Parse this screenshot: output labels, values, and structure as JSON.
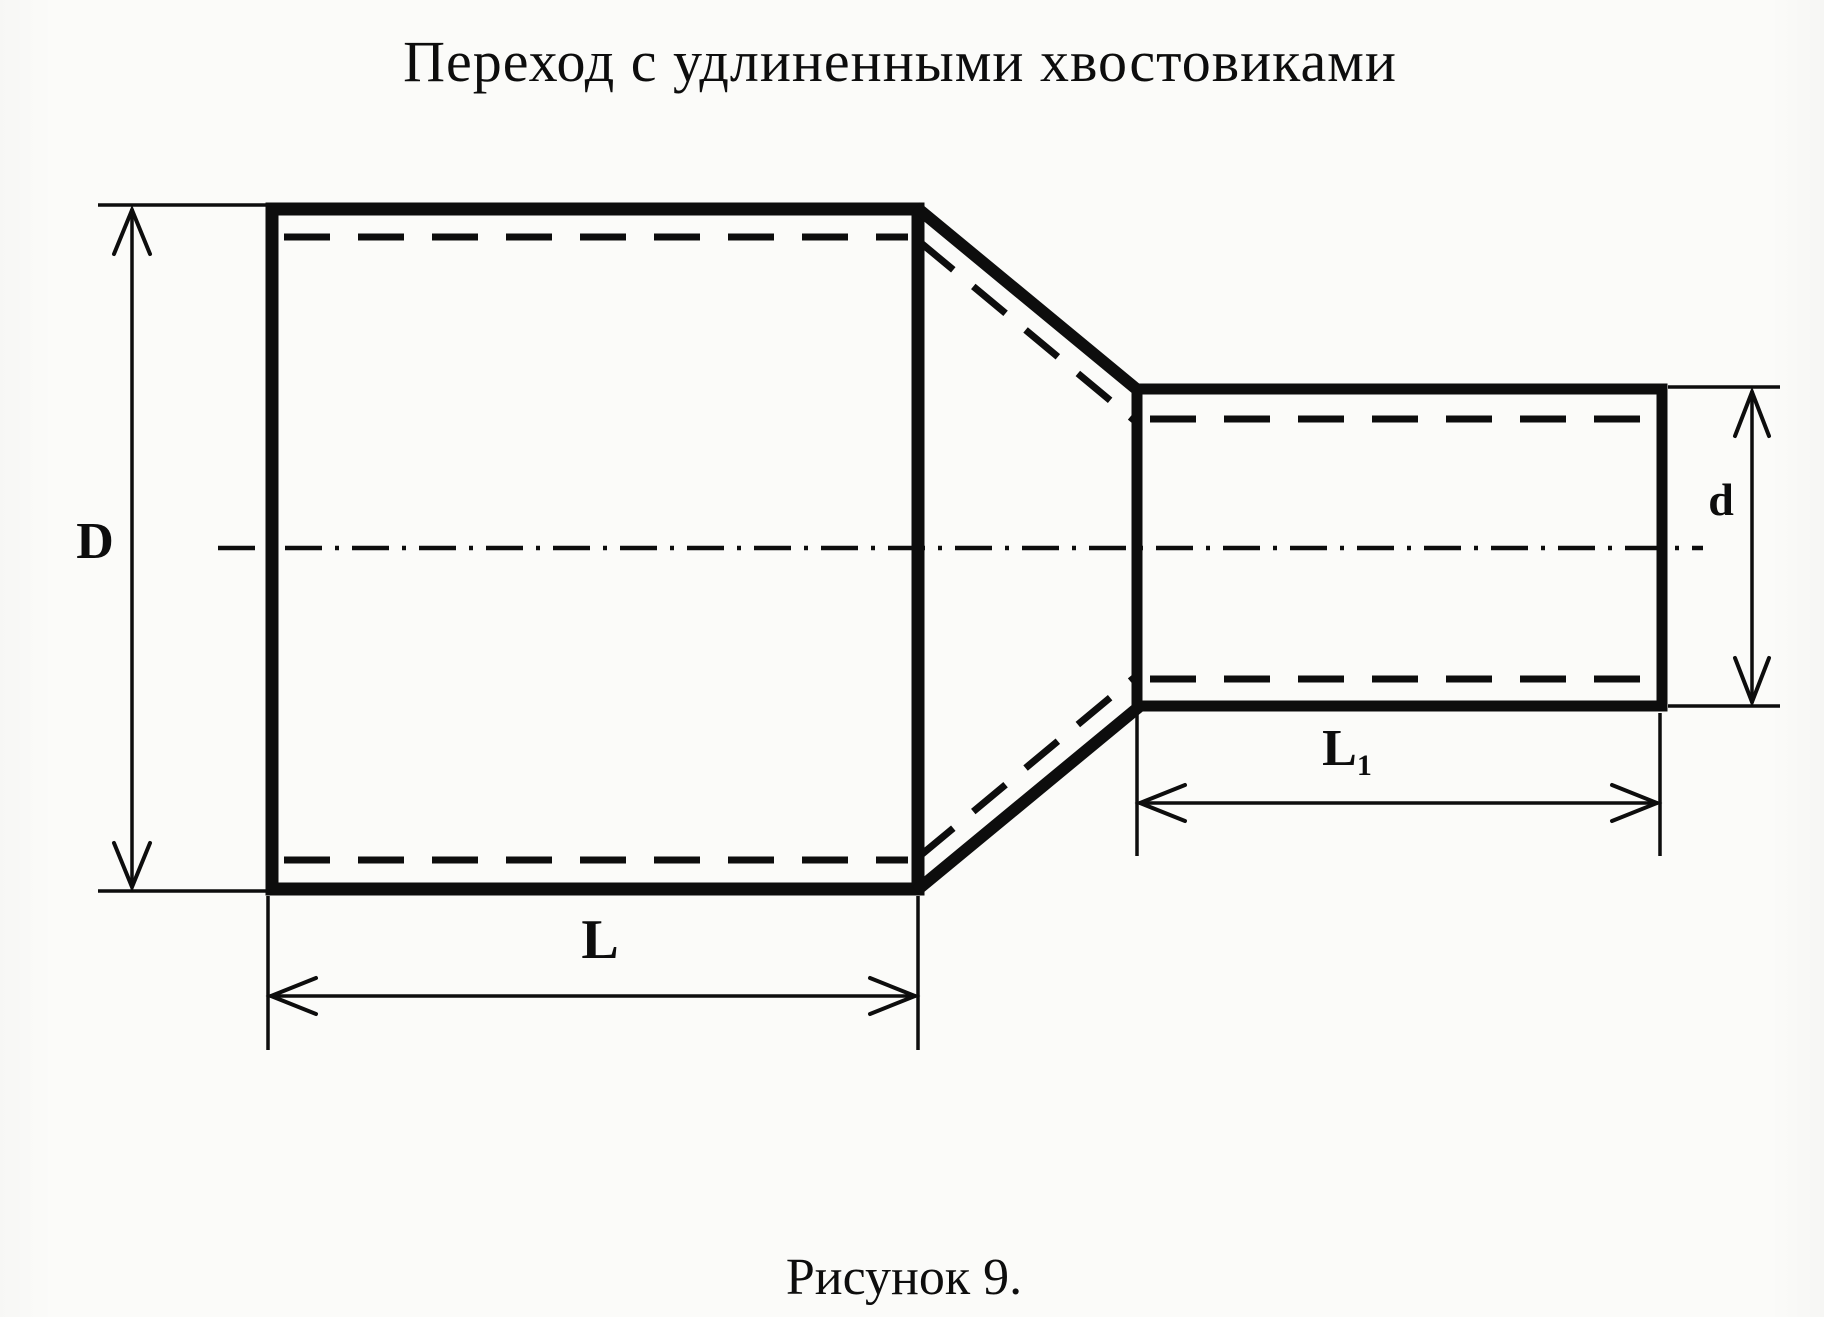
{
  "title": "Переход с удлиненными хвостовиками",
  "caption": "Рисунок 9.",
  "dimensions": {
    "large_diameter": "D",
    "small_diameter": "d",
    "large_length": "L",
    "small_length_main": "L",
    "small_length_sub": "1"
  },
  "drawing": {
    "type": "engineering-sketch",
    "subject": "pipe reducer with elongated tails, side view",
    "parts": [
      "large cylinder",
      "conical transition",
      "small cylinder"
    ],
    "line_styles": [
      "solid outline",
      "dashed bore line",
      "dash-dot centerline",
      "thin dimension lines with arrowheads"
    ]
  },
  "colors": {
    "ink": "#0d0d0d",
    "paper": "#fbfbf9"
  }
}
